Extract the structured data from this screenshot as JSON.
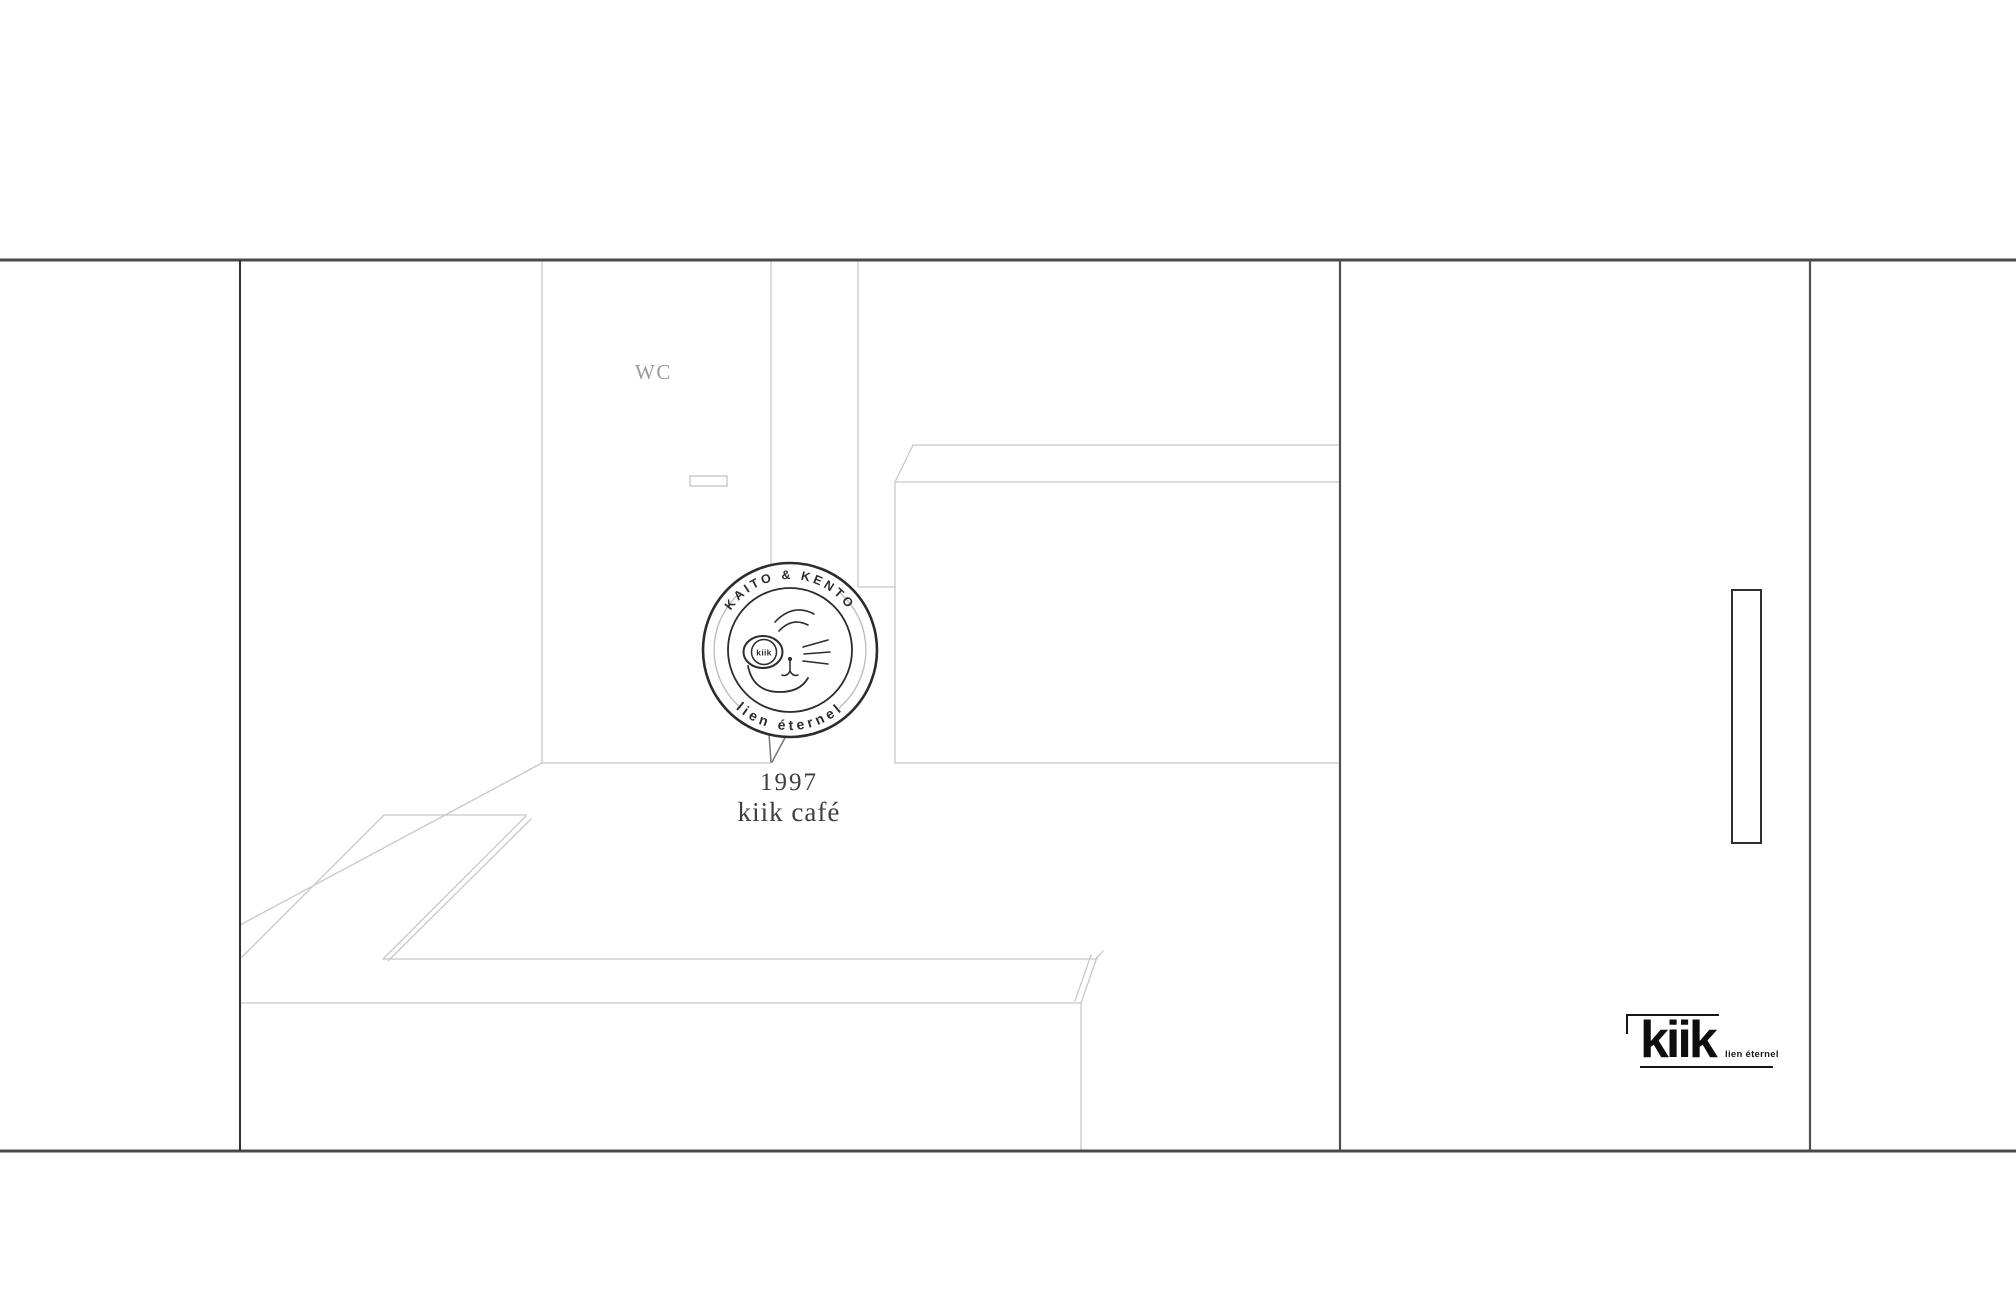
{
  "canvas": {
    "width": 2016,
    "height": 1299,
    "background": "#ffffff"
  },
  "colors": {
    "frame_dark": "#4a4a4a",
    "wall_dark": "#303030",
    "sketch_light": "#c8c8c8",
    "badge_ink": "#2c2c2c",
    "caption_ink": "#3f3f3f",
    "label_gray": "#9b9b9b",
    "brand_ink": "#0e0e0e"
  },
  "labels": {
    "wc": "WC"
  },
  "badge": {
    "arc_top": "KAITO & KENTO",
    "arc_bottom": "lien éternel",
    "center_mark": "kiik"
  },
  "caption": {
    "year": "1997",
    "name": "kiik café"
  },
  "brand": {
    "wordmark": "kiik",
    "tagline": "lien éternel"
  }
}
